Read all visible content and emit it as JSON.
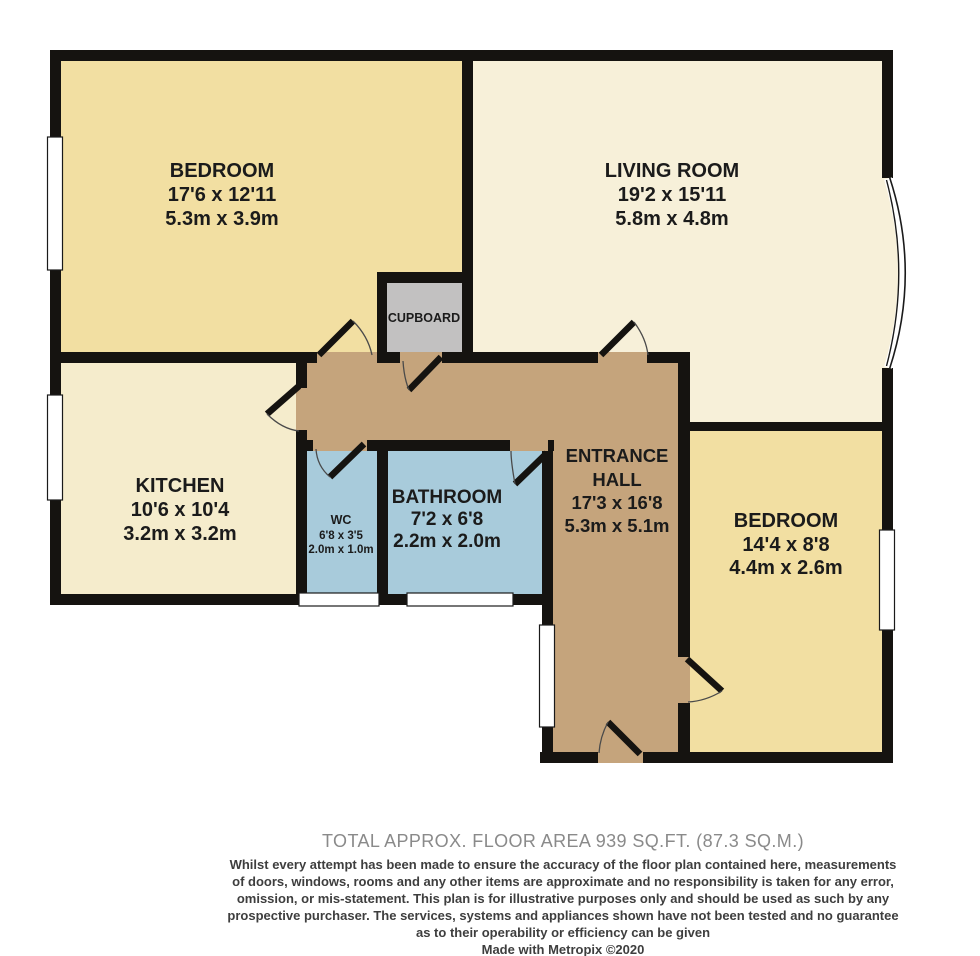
{
  "plan": {
    "colors": {
      "wall": "#151310",
      "bedroom_fill": "#F2DFA2",
      "living_fill": "#F7F0D9",
      "kitchen_fill": "#F5ECCC",
      "wet_room_fill": "#A8CBDB",
      "hall_fill": "#C5A47C",
      "cupboard_fill": "#C2C1C1"
    },
    "rooms": {
      "bedroom_tl": {
        "name": "BEDROOM",
        "imperial": "17'6 x 12'11",
        "metric": "5.3m x 3.9m"
      },
      "living": {
        "name": "LIVING ROOM",
        "imperial": "19'2 x 15'11",
        "metric": "5.8m x 4.8m"
      },
      "cupboard": {
        "name": "CUPBOARD"
      },
      "kitchen": {
        "name": "KITCHEN",
        "imperial": "10'6 x 10'4",
        "metric": "3.2m x 3.2m"
      },
      "wc": {
        "name": "WC",
        "imperial": "6'8 x 3'5",
        "metric": "2.0m x 1.0m"
      },
      "bathroom": {
        "name": "BATHROOM",
        "imperial": "7'2 x 6'8",
        "metric": "2.2m x 2.0m"
      },
      "hall": {
        "name_line1": "ENTRANCE",
        "name_line2": "HALL",
        "imperial": "17'3 x 16'8",
        "metric": "5.3m x 5.1m"
      },
      "bedroom_r": {
        "name": "BEDROOM",
        "imperial": "14'4 x 8'8",
        "metric": "4.4m x 2.6m"
      }
    }
  },
  "footer": {
    "total_area": "TOTAL APPROX. FLOOR AREA 939 SQ.FT. (87.3 SQ.M.)",
    "disclaimer_lines": [
      "Whilst every attempt has been made to ensure the accuracy of the floor plan contained here, measurements",
      "of doors, windows, rooms and any other items are approximate and no responsibility is taken for any error,",
      "omission, or mis-statement. This plan is for illustrative purposes only and should be used as such by any",
      "prospective purchaser. The services, systems and appliances shown have not been tested and no guarantee",
      "as to their operability or efficiency can be given"
    ],
    "credit": "Made with Metropix ©2020"
  }
}
